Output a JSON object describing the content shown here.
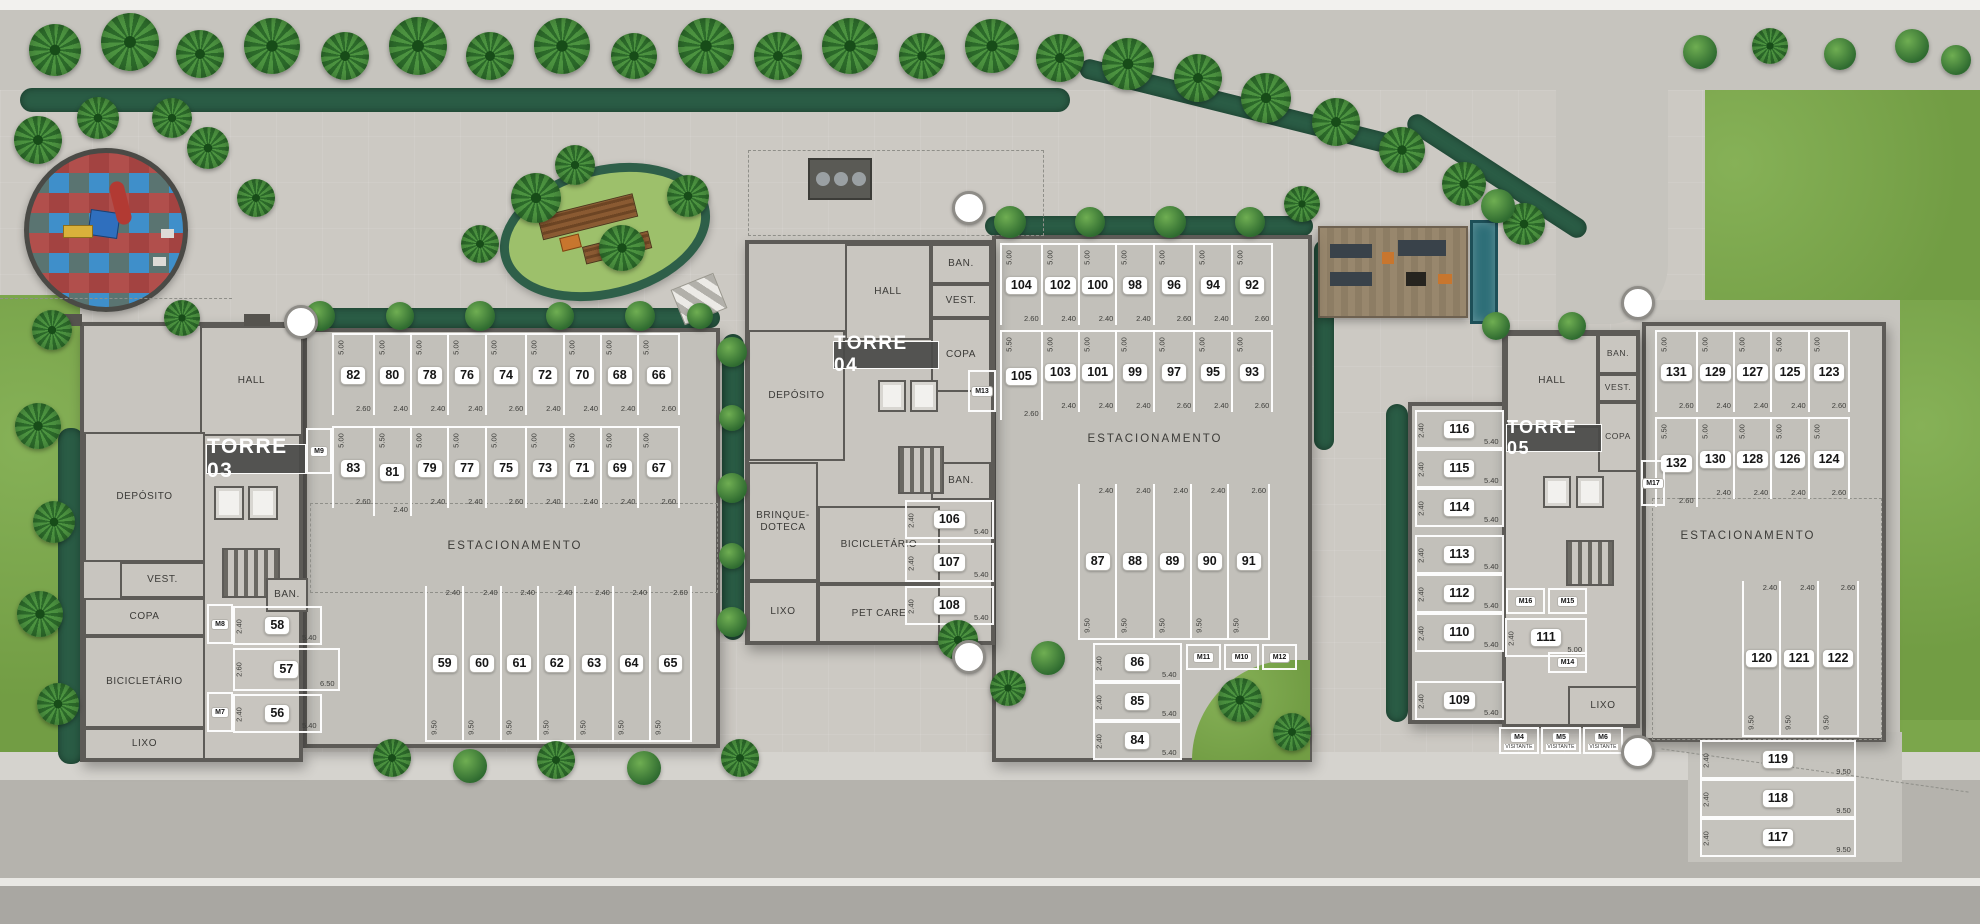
{
  "plan": {
    "labels": {
      "estacionamento": "ESTACIONAMENTO",
      "visitante": "VISITANTE"
    },
    "towers": {
      "t03": {
        "name": "TORRE 03",
        "rooms": {
          "hall": "HALL",
          "deposito": "DEPÓSITO",
          "vest": "VEST.",
          "copa": "COPA",
          "bicicletario": "BICICLETÁRIO",
          "lixo": "LIXO",
          "ban": "BAN."
        }
      },
      "t04": {
        "name": "TORRE 04",
        "rooms": {
          "hall": "HALL",
          "deposito": "DEPÓSITO",
          "ban_top": "BAN.",
          "vest": "VEST.",
          "copa": "COPA",
          "ban_mid": "BAN.",
          "brinquedoteca": "BRINQUE-DOTECA",
          "bicicletario": "BICICLETÁRIO",
          "lixo": "LIXO",
          "pet_care": "PET CARE"
        }
      },
      "t05": {
        "name": "TORRE 05",
        "rooms": {
          "hall": "HALL",
          "ban": "BAN.",
          "vest": "VEST.",
          "copa": "COPA",
          "lixo": "LIXO"
        }
      }
    },
    "parking": {
      "t03_top": {
        "numbers": [
          "82",
          "80",
          "78",
          "76",
          "74",
          "72",
          "70",
          "68",
          "66"
        ],
        "widths": [
          "2.60",
          "2.40",
          "2.40",
          "2.40",
          "2.60",
          "2.40",
          "2.40",
          "2.40",
          "2.60"
        ],
        "depths": [
          "5.00",
          "5.00",
          "5.00",
          "5.00",
          "5.00",
          "5.00",
          "5.00",
          "5.00",
          "5.00"
        ]
      },
      "t03_mid": {
        "numbers": [
          "83",
          "81",
          "79",
          "77",
          "75",
          "73",
          "71",
          "69",
          "67"
        ],
        "widths": [
          "2.60",
          "2.40",
          "2.40",
          "2.40",
          "2.60",
          "2.40",
          "2.40",
          "2.40",
          "2.60"
        ],
        "depths": [
          "5.00",
          "5.50",
          "5.00",
          "5.00",
          "5.00",
          "5.00",
          "5.00",
          "5.00",
          "5.00"
        ]
      },
      "t03_bottom": {
        "numbers": [
          "59",
          "60",
          "61",
          "62",
          "63",
          "64",
          "65"
        ],
        "widths": [
          "2.40",
          "2.40",
          "2.40",
          "2.40",
          "2.40",
          "2.40",
          "2.60"
        ],
        "depths": [
          "9.50",
          "9.50",
          "9.50",
          "9.50",
          "9.50",
          "9.50",
          "9.50"
        ]
      },
      "t03_left": {
        "numbers": [
          "58",
          "57",
          "56"
        ],
        "heights": [
          "2.40",
          "2.60",
          "2.40"
        ],
        "lengths": [
          "5.40",
          "6.50",
          "5.40"
        ]
      },
      "t04_top": {
        "numbers": [
          "104",
          "102",
          "100",
          "98",
          "96",
          "94",
          "92"
        ],
        "widths": [
          "2.60",
          "2.40",
          "2.40",
          "2.40",
          "2.60",
          "2.40",
          "2.60"
        ],
        "depths": [
          "5.00",
          "5.00",
          "5.00",
          "5.00",
          "5.00",
          "5.00",
          "5.00"
        ]
      },
      "t04_mid": {
        "numbers": [
          "105",
          "103",
          "101",
          "99",
          "97",
          "95",
          "93"
        ],
        "widths": [
          "2.60",
          "2.40",
          "2.40",
          "2.40",
          "2.60",
          "2.40",
          "2.60"
        ],
        "depths": [
          "5.50",
          "5.00",
          "5.00",
          "5.00",
          "5.00",
          "5.00",
          "5.00"
        ]
      },
      "t04_vert": {
        "numbers": [
          "87",
          "88",
          "89",
          "90",
          "91"
        ],
        "widths": [
          "2.40",
          "2.40",
          "2.40",
          "2.40",
          "2.60"
        ],
        "depths": [
          "9.50",
          "9.50",
          "9.50",
          "9.50",
          "9.50"
        ]
      },
      "t04_left": {
        "numbers": [
          "86",
          "85",
          "84"
        ],
        "heights": [
          "2.40",
          "2.40",
          "2.40"
        ],
        "lengths": [
          "5.40",
          "5.40",
          "5.40"
        ]
      },
      "t04_side": {
        "numbers": [
          "106",
          "107",
          "108"
        ],
        "heights": [
          "2.40",
          "2.40",
          "2.40"
        ],
        "lengths": [
          "5.40",
          "5.40",
          "5.40"
        ]
      },
      "t05_left": {
        "numbers": [
          "116",
          "115",
          "114",
          "113",
          "112",
          "110",
          "109"
        ],
        "heights": [
          "2.40",
          "2.40",
          "2.40",
          "2.40",
          "2.40",
          "2.40",
          "2.40"
        ],
        "lengths": [
          "5.40",
          "5.40",
          "5.40",
          "5.40",
          "5.40",
          "5.40",
          "5.40"
        ]
      },
      "t05_inner": {
        "numbers": [
          "111"
        ],
        "heights": [
          "2.40"
        ],
        "lengths": [
          "5.00"
        ]
      },
      "t05r_top": {
        "numbers": [
          "131",
          "129",
          "127",
          "125",
          "123"
        ],
        "widths": [
          "2.60",
          "2.40",
          "2.40",
          "2.40",
          "2.60"
        ],
        "depths": [
          "5.00",
          "5.00",
          "5.00",
          "5.00",
          "5.00"
        ]
      },
      "t05r_mid": {
        "numbers": [
          "132",
          "130",
          "128",
          "126",
          "124"
        ],
        "widths": [
          "2.60",
          "2.40",
          "2.40",
          "2.40",
          "2.60"
        ],
        "depths": [
          "5.50",
          "5.00",
          "5.00",
          "5.00",
          "5.00"
        ]
      },
      "t05r_vert": {
        "numbers": [
          "120",
          "121",
          "122"
        ],
        "widths": [
          "2.40",
          "2.40",
          "2.60"
        ],
        "depths": [
          "9.50",
          "9.50",
          "9.50"
        ]
      },
      "t05r_bottom": {
        "numbers": [
          "119",
          "118",
          "117"
        ],
        "heights": [
          "2.40",
          "2.40",
          "2.40"
        ],
        "lengths": [
          "9.50",
          "9.50",
          "9.50"
        ]
      },
      "moto": {
        "m4": "M4",
        "m5": "M5",
        "m6": "M6",
        "m7": "M7",
        "m8": "M8",
        "m9": "M9",
        "m10": "M10",
        "m11": "M11",
        "m12": "M12",
        "m13": "M13",
        "m14": "M14",
        "m15": "M15",
        "m16": "M16",
        "m17": "M17"
      }
    },
    "colors": {
      "lawn": "#7ba64b",
      "paving": "#ccc9c3",
      "road": "#b5b3ad",
      "wall": "#5d5b57",
      "hedge": "#2a5c45",
      "play_red": "#a34341",
      "play_blue": "#3f8fca",
      "play_slate": "#5a7471"
    }
  }
}
